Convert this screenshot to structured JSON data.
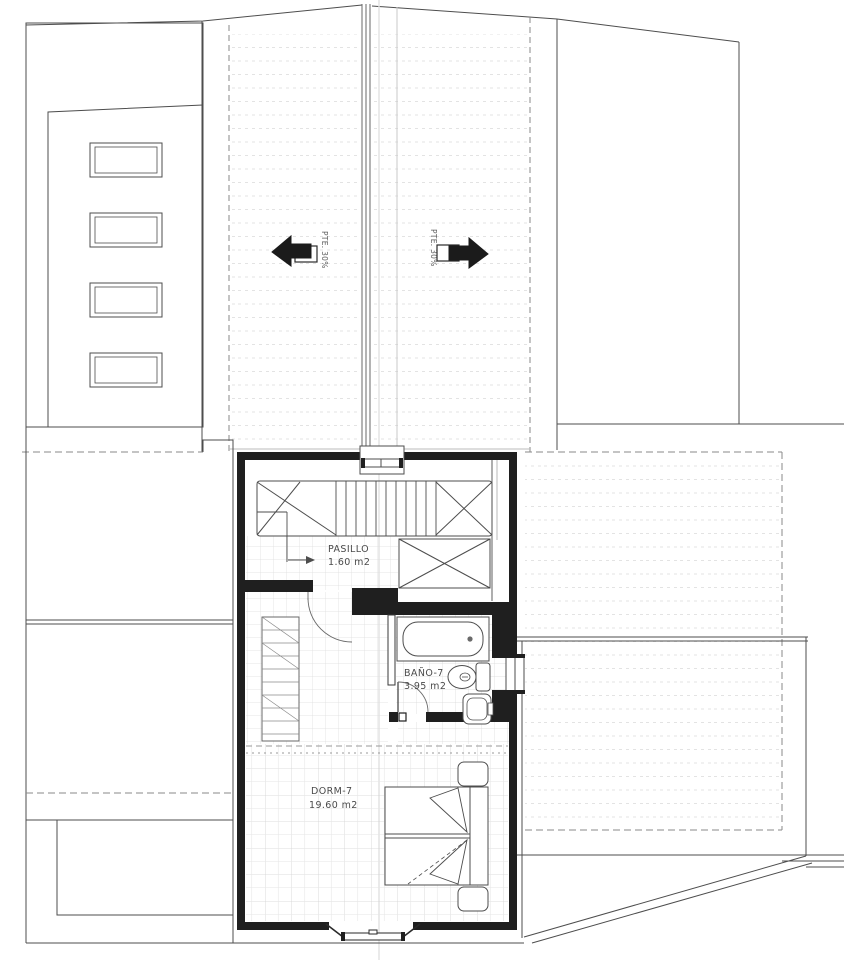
{
  "drawing": {
    "title": "planta bajo cubierta - floor plan",
    "rooms": [
      {
        "id": "pasillo",
        "label": "PASILLO",
        "area": "1.60 m2"
      },
      {
        "id": "bano",
        "label": "BAÑO-7",
        "area": "3.95 m2"
      },
      {
        "id": "dorm",
        "label": "DORM-7",
        "area": "19.60 m2"
      }
    ],
    "slope_arrows": {
      "left": {
        "label": "PTE. 30%",
        "direction": "left"
      },
      "right": {
        "label": "PTE. 30%",
        "direction": "right"
      }
    },
    "fixtures": [
      "bathtub",
      "toilet",
      "sink",
      "bed",
      "nightstand",
      "closet",
      "staircase",
      "skylight",
      "window"
    ],
    "colors": {
      "line": "#4d4d4d",
      "wall": "#1f1f1f",
      "grid": "#dcdcdc",
      "faint": "#c9c9c9"
    }
  }
}
